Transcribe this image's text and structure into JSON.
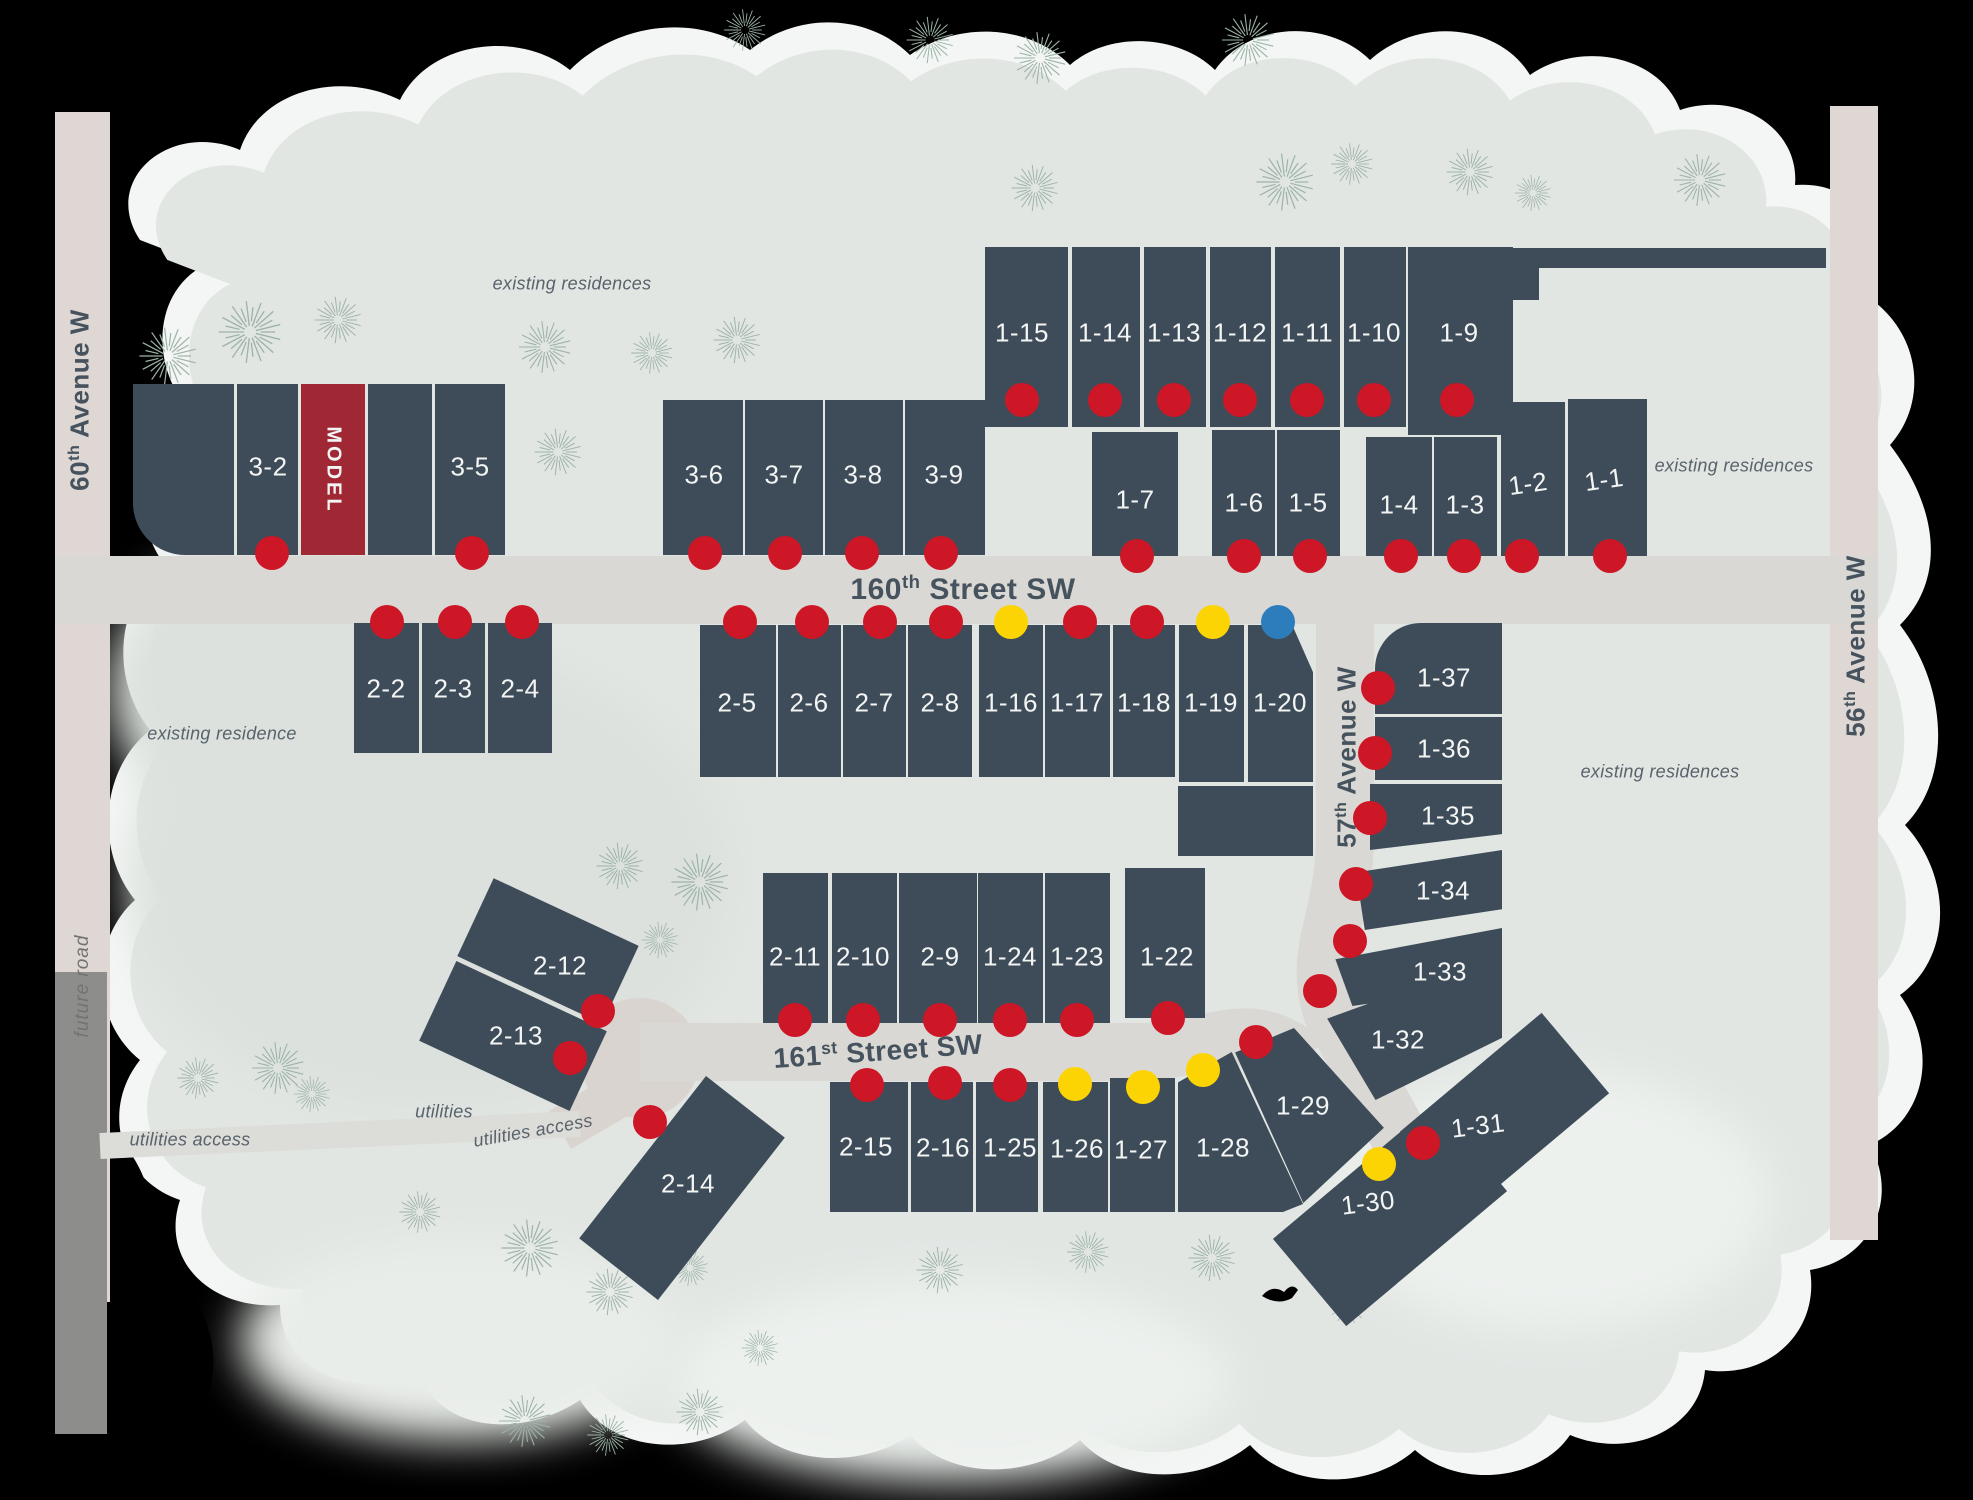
{
  "title": "residential community site plan",
  "colors": {
    "lot": "#3e4c59",
    "model": "#a02835",
    "dot_red": "#cd1626",
    "dot_yellow": "#fcd403",
    "dot_blue": "#2d7cbc",
    "road": "#d9d8d4",
    "avenue": "#ded7d4",
    "future_road": "#8d8d8b",
    "culdesac": "#dad4d0",
    "map_bg": "#e2e6e3",
    "fringe": "#f3f6f4",
    "patch_dark": "#dce1dd",
    "patch_light": "#edf1ee",
    "label": "#f3f5f4",
    "street_text": "#46535e",
    "note_text": "#59636b",
    "tree": "#9db4a7"
  },
  "streets": [
    {
      "id": "160th-street-sw",
      "pre": "160",
      "sup": "th",
      "rest": " Street SW",
      "x": 963,
      "y": 589,
      "rot": 0,
      "size": 30
    },
    {
      "id": "161st-street-sw",
      "pre": "161",
      "sup": "st",
      "rest": " Street SW",
      "x": 878,
      "y": 1051,
      "rot": -4,
      "size": 28
    },
    {
      "id": "57th-avenue-w",
      "pre": "57",
      "sup": "th",
      "rest": " Avenue W",
      "x": 1347,
      "y": 757,
      "rot": -90,
      "size": 26
    },
    {
      "id": "60th-avenue-w",
      "pre": "60",
      "sup": "th",
      "rest": " Avenue W",
      "x": 80,
      "y": 400,
      "rot": -90,
      "size": 26
    },
    {
      "id": "56th-avenue-w",
      "pre": "56",
      "sup": "th",
      "rest": " Avenue W",
      "x": 1856,
      "y": 646,
      "rot": -90,
      "size": 26
    },
    {
      "id": "future-road",
      "pre": "",
      "sup": "",
      "rest": "future road",
      "x": 83,
      "y": 986,
      "rot": -90,
      "size": 19,
      "cls": "future"
    }
  ],
  "notes": [
    {
      "text": "existing residences",
      "x": 572,
      "y": 284
    },
    {
      "text": "existing residences",
      "x": 1734,
      "y": 466
    },
    {
      "text": "existing residences",
      "x": 1660,
      "y": 772
    },
    {
      "text": "existing residence",
      "x": 222,
      "y": 734
    },
    {
      "text": "utilities",
      "x": 444,
      "y": 1112
    },
    {
      "text": "utilities access",
      "x": 190,
      "y": 1140
    },
    {
      "text": "utilities access",
      "x": 533,
      "y": 1131,
      "rot": -10
    }
  ],
  "lots": [
    {
      "id": "",
      "x": 133,
      "y": 384,
      "w": 101,
      "h": 171,
      "shape": "rbl"
    },
    {
      "id": "3-2",
      "x": 237,
      "y": 384,
      "w": 61,
      "h": 171,
      "label": {
        "x": 268,
        "y": 467
      }
    },
    {
      "id": "MODEL",
      "x": 301,
      "y": 384,
      "w": 64,
      "h": 171,
      "model": true,
      "label": {
        "x": 333,
        "y": 470,
        "rot": 90
      }
    },
    {
      "id": "",
      "x": 368,
      "y": 384,
      "w": 64,
      "h": 171
    },
    {
      "id": "3-5",
      "x": 435,
      "y": 384,
      "w": 70,
      "h": 171,
      "label": {
        "x": 470,
        "y": 467
      }
    },
    {
      "id": "3-6",
      "x": 663,
      "y": 400,
      "w": 80,
      "h": 155,
      "label": {
        "x": 704,
        "y": 475
      }
    },
    {
      "id": "3-7",
      "x": 745,
      "y": 400,
      "w": 78,
      "h": 155,
      "label": {
        "x": 784,
        "y": 475
      }
    },
    {
      "id": "3-8",
      "x": 825,
      "y": 400,
      "w": 78,
      "h": 155,
      "label": {
        "x": 863,
        "y": 475
      }
    },
    {
      "id": "3-9",
      "x": 905,
      "y": 400,
      "w": 80,
      "h": 155,
      "label": {
        "x": 944,
        "y": 475
      }
    },
    {
      "id": "1-15",
      "x": 985,
      "y": 247,
      "w": 83,
      "h": 180,
      "label": {
        "x": 1022,
        "y": 333
      }
    },
    {
      "id": "1-14",
      "x": 1072,
      "y": 247,
      "w": 68,
      "h": 180,
      "label": {
        "x": 1105,
        "y": 333
      }
    },
    {
      "id": "1-13",
      "x": 1144,
      "y": 247,
      "w": 62,
      "h": 180,
      "label": {
        "x": 1174,
        "y": 333
      }
    },
    {
      "id": "1-12",
      "x": 1210,
      "y": 247,
      "w": 61,
      "h": 180,
      "label": {
        "x": 1240,
        "y": 333
      }
    },
    {
      "id": "1-11",
      "x": 1275,
      "y": 247,
      "w": 65,
      "h": 180,
      "label": {
        "x": 1307,
        "y": 333
      }
    },
    {
      "id": "1-10",
      "x": 1344,
      "y": 247,
      "w": 62,
      "h": 180,
      "label": {
        "x": 1374,
        "y": 333
      }
    },
    {
      "id": "1-9",
      "x": 1408,
      "y": 247,
      "w": 105,
      "h": 188,
      "label": {
        "x": 1459,
        "y": 333
      }
    },
    {
      "id": "",
      "x": 1513,
      "y": 248,
      "w": 313,
      "h": 20
    },
    {
      "id": "",
      "x": 1513,
      "y": 248,
      "w": 26,
      "h": 52
    },
    {
      "id": "1-7",
      "x": 1092,
      "y": 432,
      "w": 86,
      "h": 124,
      "label": {
        "x": 1135,
        "y": 500
      }
    },
    {
      "id": "1-6",
      "x": 1212,
      "y": 430,
      "w": 63,
      "h": 126,
      "label": {
        "x": 1244,
        "y": 503
      }
    },
    {
      "id": "1-5",
      "x": 1277,
      "y": 430,
      "w": 63,
      "h": 126,
      "label": {
        "x": 1308,
        "y": 503
      }
    },
    {
      "id": "1-4",
      "x": 1366,
      "y": 437,
      "w": 66,
      "h": 119,
      "label": {
        "x": 1399,
        "y": 505
      }
    },
    {
      "id": "1-3",
      "x": 1434,
      "y": 437,
      "w": 63,
      "h": 119,
      "label": {
        "x": 1465,
        "y": 505
      }
    },
    {
      "id": "1-2",
      "x": 1501,
      "y": 402,
      "w": 64,
      "h": 154,
      "label": {
        "x": 1528,
        "y": 484,
        "rot": -8
      }
    },
    {
      "id": "1-1",
      "x": 1568,
      "y": 399,
      "w": 79,
      "h": 157,
      "label": {
        "x": 1604,
        "y": 480,
        "rot": -8
      }
    },
    {
      "id": "2-2",
      "x": 354,
      "y": 623,
      "w": 65,
      "h": 130,
      "label": {
        "x": 386,
        "y": 689
      }
    },
    {
      "id": "2-3",
      "x": 422,
      "y": 623,
      "w": 63,
      "h": 130,
      "label": {
        "x": 453,
        "y": 689
      }
    },
    {
      "id": "2-4",
      "x": 488,
      "y": 623,
      "w": 64,
      "h": 130,
      "label": {
        "x": 520,
        "y": 689
      }
    },
    {
      "id": "2-5",
      "x": 700,
      "y": 625,
      "w": 76,
      "h": 152,
      "label": {
        "x": 737,
        "y": 703
      }
    },
    {
      "id": "2-6",
      "x": 778,
      "y": 625,
      "w": 63,
      "h": 152,
      "label": {
        "x": 809,
        "y": 703
      }
    },
    {
      "id": "2-7",
      "x": 843,
      "y": 625,
      "w": 63,
      "h": 152,
      "label": {
        "x": 874,
        "y": 703
      }
    },
    {
      "id": "2-8",
      "x": 908,
      "y": 625,
      "w": 64,
      "h": 152,
      "label": {
        "x": 940,
        "y": 703
      }
    },
    {
      "id": "1-16",
      "x": 979,
      "y": 625,
      "w": 64,
      "h": 152,
      "label": {
        "x": 1011,
        "y": 703
      }
    },
    {
      "id": "1-17",
      "x": 1045,
      "y": 625,
      "w": 65,
      "h": 152,
      "label": {
        "x": 1077,
        "y": 703
      }
    },
    {
      "id": "1-18",
      "x": 1113,
      "y": 625,
      "w": 62,
      "h": 152,
      "label": {
        "x": 1144,
        "y": 703
      }
    },
    {
      "id": "1-19",
      "x": 1179,
      "y": 625,
      "w": 65,
      "h": 157,
      "label": {
        "x": 1211,
        "y": 703
      }
    },
    {
      "id": "1-20",
      "x": 1248,
      "y": 625,
      "w": 65,
      "h": 157,
      "shape": "cut-tr",
      "label": {
        "x": 1280,
        "y": 703
      }
    },
    {
      "id": "",
      "x": 1178,
      "y": 786,
      "w": 135,
      "h": 70
    },
    {
      "id": "1-37",
      "x": 1375,
      "y": 623,
      "w": 127,
      "h": 91,
      "shape": "rtl",
      "label": {
        "x": 1444,
        "y": 678
      }
    },
    {
      "id": "1-36",
      "x": 1375,
      "y": 717,
      "w": 127,
      "h": 63,
      "label": {
        "x": 1444,
        "y": 749
      }
    },
    {
      "id": "1-35",
      "x": 1370,
      "y": 784,
      "w": 132,
      "h": 66,
      "clip": "polygon(0% 0%,100% 0%,100% 76%,0% 100%)",
      "label": {
        "x": 1448,
        "y": 816
      }
    },
    {
      "id": "1-34",
      "x": 1356,
      "y": 850,
      "w": 146,
      "h": 80,
      "clip": "polygon(0% 28%,100% 0%,100% 74%,6% 100%)",
      "label": {
        "x": 1443,
        "y": 891
      }
    },
    {
      "id": "1-33",
      "x": 1332,
      "y": 928,
      "w": 170,
      "h": 78,
      "clip": "polygon(2% 40%,100% 0%,100% 72%,12% 100%)",
      "label": {
        "x": 1440,
        "y": 972
      }
    },
    {
      "id": "1-32",
      "x": 1316,
      "y": 952,
      "w": 186,
      "h": 148,
      "clip": "polygon(6% 45%,100% 2%,100% 58%,32% 100%)",
      "label": {
        "x": 1398,
        "y": 1040
      }
    },
    {
      "id": "1-31",
      "x": 1412,
      "y": 1060,
      "w": 185,
      "h": 105,
      "rot": -40,
      "label": {
        "x": 1478,
        "y": 1126,
        "rot": -7
      }
    },
    {
      "id": "1-30",
      "x": 1285,
      "y": 1158,
      "w": 210,
      "h": 114,
      "rot": -40,
      "label": {
        "x": 1368,
        "y": 1203,
        "rot": -7
      }
    },
    {
      "id": "1-29",
      "x": 1232,
      "y": 1028,
      "w": 155,
      "h": 175,
      "clip": "polygon(2% 14%,40% 0%,98% 57%,46% 100%)",
      "label": {
        "x": 1303,
        "y": 1106
      }
    },
    {
      "id": "1-28",
      "x": 1178,
      "y": 1052,
      "w": 125,
      "h": 160,
      "clip": "polygon(0% 19%,43% 0%,100% 95%,84% 100%,0% 100%)",
      "label": {
        "x": 1223,
        "y": 1148
      }
    },
    {
      "id": "2-11",
      "x": 763,
      "y": 873,
      "w": 65,
      "h": 150,
      "label": {
        "x": 795,
        "y": 957
      }
    },
    {
      "id": "2-10",
      "x": 832,
      "y": 873,
      "w": 65,
      "h": 150,
      "label": {
        "x": 863,
        "y": 957
      }
    },
    {
      "id": "2-9",
      "x": 899,
      "y": 873,
      "w": 78,
      "h": 150,
      "label": {
        "x": 940,
        "y": 957
      }
    },
    {
      "id": "1-24",
      "x": 978,
      "y": 873,
      "w": 65,
      "h": 150,
      "label": {
        "x": 1010,
        "y": 957
      }
    },
    {
      "id": "1-23",
      "x": 1045,
      "y": 873,
      "w": 65,
      "h": 150,
      "label": {
        "x": 1077,
        "y": 957
      }
    },
    {
      "id": "1-22",
      "x": 1125,
      "y": 868,
      "w": 80,
      "h": 150,
      "label": {
        "x": 1167,
        "y": 957
      }
    },
    {
      "id": "2-12",
      "x": 468,
      "y": 908,
      "w": 160,
      "h": 86,
      "rot": 25,
      "label": {
        "x": 560,
        "y": 966
      }
    },
    {
      "id": "2-13",
      "x": 430,
      "y": 992,
      "w": 166,
      "h": 88,
      "rot": 25,
      "label": {
        "x": 516,
        "y": 1036
      }
    },
    {
      "id": "2-14",
      "x": 632,
      "y": 1085,
      "w": 100,
      "h": 206,
      "rot": 38,
      "label": {
        "x": 688,
        "y": 1184
      }
    },
    {
      "id": "2-15",
      "x": 830,
      "y": 1082,
      "w": 78,
      "h": 130,
      "label": {
        "x": 866,
        "y": 1147
      }
    },
    {
      "id": "2-16",
      "x": 911,
      "y": 1082,
      "w": 62,
      "h": 130,
      "label": {
        "x": 943,
        "y": 1148
      }
    },
    {
      "id": "1-25",
      "x": 976,
      "y": 1082,
      "w": 62,
      "h": 130,
      "label": {
        "x": 1010,
        "y": 1148
      }
    },
    {
      "id": "1-26",
      "x": 1043,
      "y": 1082,
      "w": 65,
      "h": 130,
      "label": {
        "x": 1077,
        "y": 1149
      }
    },
    {
      "id": "1-27",
      "x": 1110,
      "y": 1078,
      "w": 65,
      "h": 134,
      "label": {
        "x": 1141,
        "y": 1150
      }
    }
  ],
  "dots": [
    {
      "x": 272,
      "y": 553,
      "c": "r"
    },
    {
      "x": 472,
      "y": 553,
      "c": "r"
    },
    {
      "x": 705,
      "y": 553,
      "c": "r"
    },
    {
      "x": 785,
      "y": 553,
      "c": "r"
    },
    {
      "x": 862,
      "y": 553,
      "c": "r"
    },
    {
      "x": 941,
      "y": 553,
      "c": "r"
    },
    {
      "x": 1022,
      "y": 400,
      "c": "r"
    },
    {
      "x": 1105,
      "y": 400,
      "c": "r"
    },
    {
      "x": 1174,
      "y": 400,
      "c": "r"
    },
    {
      "x": 1240,
      "y": 400,
      "c": "r"
    },
    {
      "x": 1307,
      "y": 400,
      "c": "r"
    },
    {
      "x": 1374,
      "y": 400,
      "c": "r"
    },
    {
      "x": 1457,
      "y": 400,
      "c": "r"
    },
    {
      "x": 1137,
      "y": 556,
      "c": "r"
    },
    {
      "x": 1244,
      "y": 556,
      "c": "r"
    },
    {
      "x": 1310,
      "y": 556,
      "c": "r"
    },
    {
      "x": 1401,
      "y": 556,
      "c": "r"
    },
    {
      "x": 1464,
      "y": 556,
      "c": "r"
    },
    {
      "x": 1522,
      "y": 556,
      "c": "r"
    },
    {
      "x": 1610,
      "y": 556,
      "c": "r"
    },
    {
      "x": 387,
      "y": 622,
      "c": "r"
    },
    {
      "x": 455,
      "y": 622,
      "c": "r"
    },
    {
      "x": 522,
      "y": 622,
      "c": "r"
    },
    {
      "x": 740,
      "y": 622,
      "c": "r"
    },
    {
      "x": 812,
      "y": 622,
      "c": "r"
    },
    {
      "x": 880,
      "y": 622,
      "c": "r"
    },
    {
      "x": 946,
      "y": 622,
      "c": "r"
    },
    {
      "x": 1011,
      "y": 622,
      "c": "y"
    },
    {
      "x": 1080,
      "y": 622,
      "c": "r"
    },
    {
      "x": 1147,
      "y": 622,
      "c": "r"
    },
    {
      "x": 1213,
      "y": 622,
      "c": "y"
    },
    {
      "x": 1278,
      "y": 622,
      "c": "b"
    },
    {
      "x": 1378,
      "y": 688,
      "c": "r"
    },
    {
      "x": 1375,
      "y": 753,
      "c": "r"
    },
    {
      "x": 1370,
      "y": 818,
      "c": "r"
    },
    {
      "x": 1356,
      "y": 884,
      "c": "r"
    },
    {
      "x": 1350,
      "y": 941,
      "c": "r"
    },
    {
      "x": 1320,
      "y": 991,
      "c": "r"
    },
    {
      "x": 795,
      "y": 1020,
      "c": "r"
    },
    {
      "x": 863,
      "y": 1020,
      "c": "r"
    },
    {
      "x": 940,
      "y": 1020,
      "c": "r"
    },
    {
      "x": 1010,
      "y": 1020,
      "c": "r"
    },
    {
      "x": 1077,
      "y": 1020,
      "c": "r"
    },
    {
      "x": 1168,
      "y": 1018,
      "c": "r"
    },
    {
      "x": 598,
      "y": 1011,
      "c": "r"
    },
    {
      "x": 570,
      "y": 1058,
      "c": "r"
    },
    {
      "x": 650,
      "y": 1122,
      "c": "r"
    },
    {
      "x": 867,
      "y": 1085,
      "c": "r"
    },
    {
      "x": 945,
      "y": 1083,
      "c": "r"
    },
    {
      "x": 1010,
      "y": 1085,
      "c": "r"
    },
    {
      "x": 1075,
      "y": 1084,
      "c": "y"
    },
    {
      "x": 1143,
      "y": 1087,
      "c": "y"
    },
    {
      "x": 1203,
      "y": 1070,
      "c": "y"
    },
    {
      "x": 1256,
      "y": 1042,
      "c": "r"
    },
    {
      "x": 1379,
      "y": 1164,
      "c": "y"
    },
    {
      "x": 1423,
      "y": 1143,
      "c": "r"
    }
  ],
  "trees": [
    {
      "x": 168,
      "y": 356,
      "s": 1.1
    },
    {
      "x": 250,
      "y": 332,
      "s": 1.2
    },
    {
      "x": 338,
      "y": 320,
      "s": 0.9
    },
    {
      "x": 545,
      "y": 347,
      "s": 1.0
    },
    {
      "x": 652,
      "y": 353,
      "s": 0.8
    },
    {
      "x": 737,
      "y": 340,
      "s": 0.9
    },
    {
      "x": 558,
      "y": 452,
      "s": 0.9
    },
    {
      "x": 745,
      "y": 30,
      "s": 0.8
    },
    {
      "x": 930,
      "y": 40,
      "s": 0.9
    },
    {
      "x": 1040,
      "y": 58,
      "s": 1.0
    },
    {
      "x": 1248,
      "y": 40,
      "s": 1.0
    },
    {
      "x": 1035,
      "y": 188,
      "s": 0.9
    },
    {
      "x": 1285,
      "y": 182,
      "s": 1.1
    },
    {
      "x": 1352,
      "y": 164,
      "s": 0.8
    },
    {
      "x": 1470,
      "y": 172,
      "s": 0.9
    },
    {
      "x": 1533,
      "y": 193,
      "s": 0.7
    },
    {
      "x": 1700,
      "y": 180,
      "s": 1.0
    },
    {
      "x": 620,
      "y": 866,
      "s": 0.9
    },
    {
      "x": 700,
      "y": 882,
      "s": 1.1
    },
    {
      "x": 660,
      "y": 940,
      "s": 0.7
    },
    {
      "x": 198,
      "y": 1078,
      "s": 0.8
    },
    {
      "x": 278,
      "y": 1068,
      "s": 1.0
    },
    {
      "x": 312,
      "y": 1094,
      "s": 0.7
    },
    {
      "x": 420,
      "y": 1212,
      "s": 0.8
    },
    {
      "x": 530,
      "y": 1248,
      "s": 1.1
    },
    {
      "x": 610,
      "y": 1292,
      "s": 0.9
    },
    {
      "x": 690,
      "y": 1268,
      "s": 0.7
    },
    {
      "x": 525,
      "y": 1421,
      "s": 1.0
    },
    {
      "x": 608,
      "y": 1435,
      "s": 0.8
    },
    {
      "x": 700,
      "y": 1412,
      "s": 0.9
    },
    {
      "x": 760,
      "y": 1348,
      "s": 0.7
    },
    {
      "x": 940,
      "y": 1270,
      "s": 0.9
    },
    {
      "x": 1088,
      "y": 1252,
      "s": 0.8
    },
    {
      "x": 1212,
      "y": 1258,
      "s": 0.9
    },
    {
      "x": 1348,
      "y": 1306,
      "s": 0.7
    }
  ]
}
